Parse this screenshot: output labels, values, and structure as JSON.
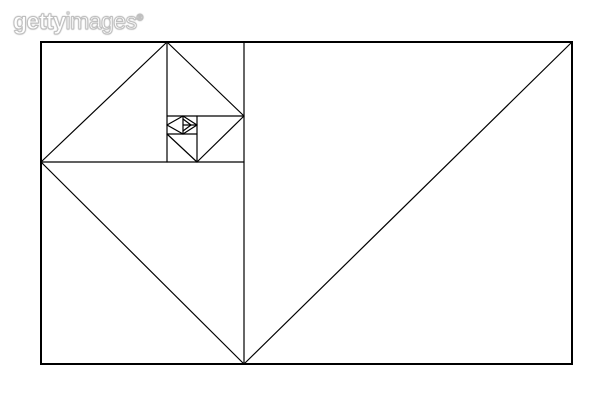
{
  "watermark": {
    "brand_bold": "getty",
    "brand_light": "images",
    "registered": "®"
  },
  "diagram": {
    "title_semantic": "golden-ratio-fibonacci-triangles",
    "canvas": {
      "width": 612,
      "height": 408
    },
    "background_color": "#ffffff",
    "stroke_color": "#000000",
    "outer_stroke_width": 2,
    "inner_stroke_width": 1.2,
    "outer_rect": {
      "x1": 41,
      "y1": 42,
      "x2": 572,
      "y2": 364
    },
    "structure_lines": [
      {
        "x1": 244,
        "y1": 42,
        "x2": 244,
        "y2": 364
      },
      {
        "x1": 167,
        "y1": 42,
        "x2": 167,
        "y2": 162
      },
      {
        "x1": 41,
        "y1": 162,
        "x2": 244,
        "y2": 162
      },
      {
        "x1": 167,
        "y1": 116,
        "x2": 244,
        "y2": 116
      },
      {
        "x1": 197,
        "y1": 116,
        "x2": 197,
        "y2": 162
      },
      {
        "x1": 167,
        "y1": 134,
        "x2": 197,
        "y2": 134
      },
      {
        "x1": 183,
        "y1": 116,
        "x2": 183,
        "y2": 134
      },
      {
        "x1": 183,
        "y1": 125,
        "x2": 197,
        "y2": 125
      }
    ],
    "spiral_chords": [
      {
        "x1": 244,
        "y1": 364,
        "x2": 572,
        "y2": 42
      },
      {
        "x1": 41,
        "y1": 162,
        "x2": 244,
        "y2": 364
      },
      {
        "x1": 41,
        "y1": 162,
        "x2": 167,
        "y2": 42
      },
      {
        "x1": 167,
        "y1": 42,
        "x2": 244,
        "y2": 116
      },
      {
        "x1": 244,
        "y1": 116,
        "x2": 197,
        "y2": 162
      },
      {
        "x1": 197,
        "y1": 162,
        "x2": 167,
        "y2": 134
      }
    ],
    "inner_diamond": [
      {
        "x1": 167,
        "y1": 125,
        "x2": 183,
        "y2": 116
      },
      {
        "x1": 183,
        "y1": 116,
        "x2": 197,
        "y2": 125
      },
      {
        "x1": 197,
        "y1": 125,
        "x2": 183,
        "y2": 134
      },
      {
        "x1": 183,
        "y1": 134,
        "x2": 167,
        "y2": 125
      }
    ],
    "inner_triangle": [
      {
        "x1": 183,
        "y1": 119,
        "x2": 191,
        "y2": 125
      },
      {
        "x1": 191,
        "y1": 125,
        "x2": 183,
        "y2": 131
      }
    ]
  }
}
